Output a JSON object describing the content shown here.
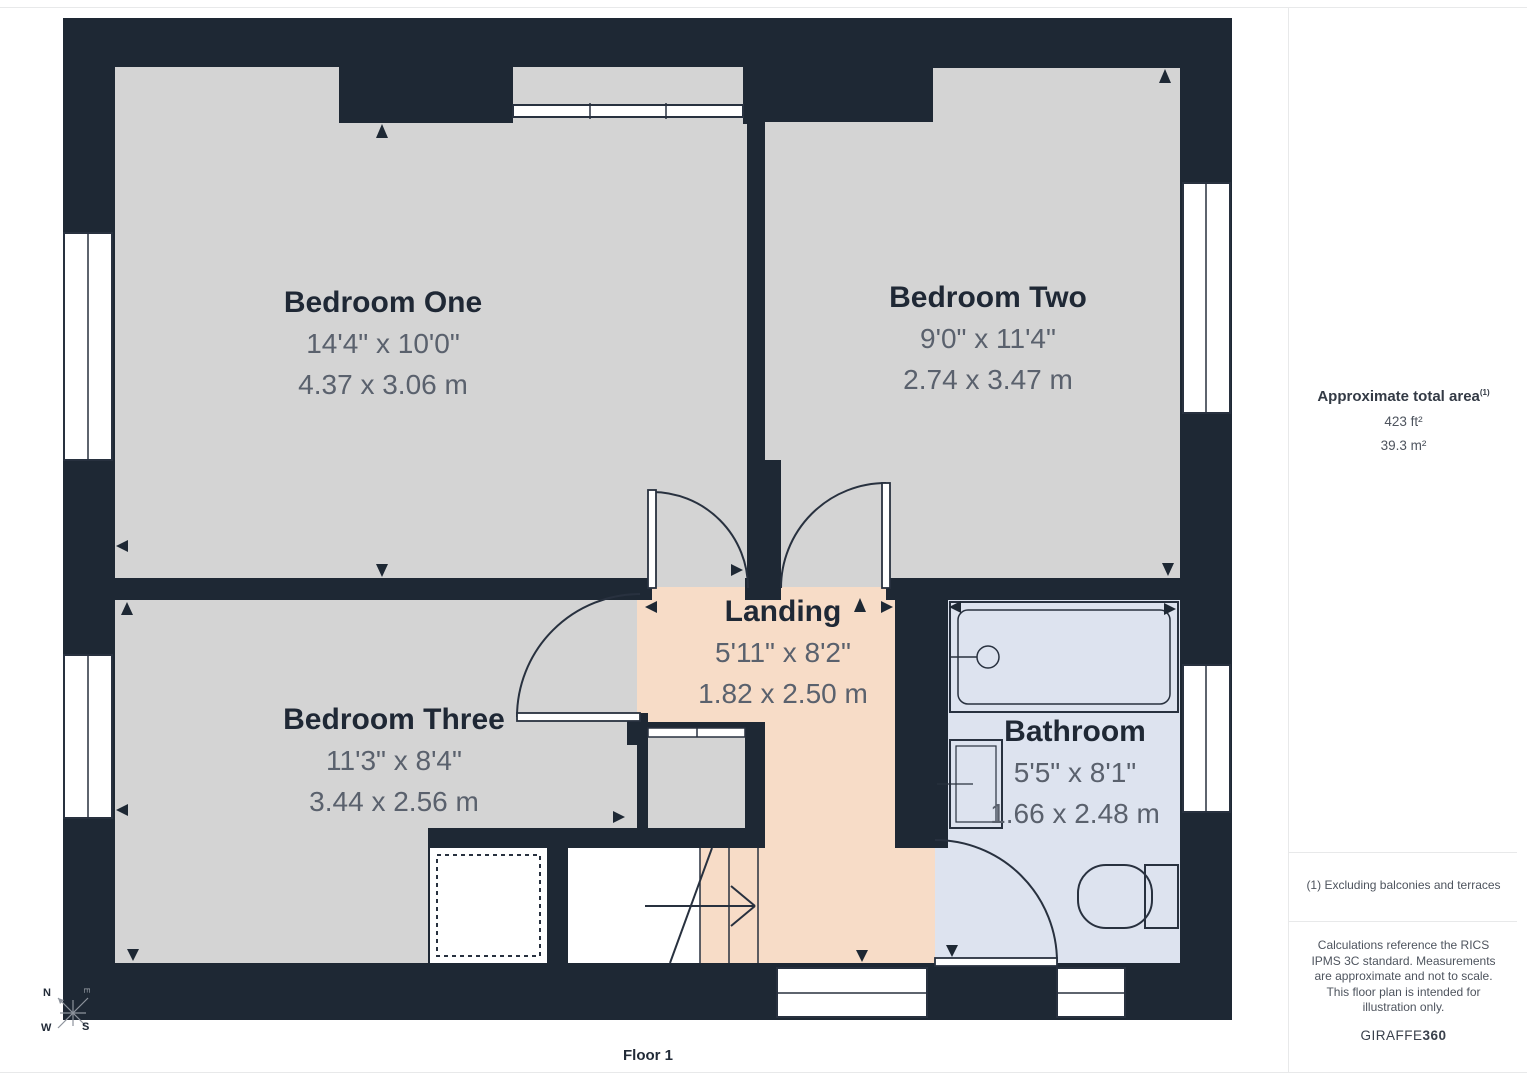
{
  "plan": {
    "floor_label": "Floor 1",
    "rooms": [
      {
        "name": "Bedroom One",
        "imperial": "14'4\" x 10'0\"",
        "metric": "4.37 x 3.06 m"
      },
      {
        "name": "Bedroom Two",
        "imperial": "9'0\" x 11'4\"",
        "metric": "2.74 x 3.47 m"
      },
      {
        "name": "Bedroom Three",
        "imperial": "11'3\" x 8'4\"",
        "metric": "3.44 x 2.56 m"
      },
      {
        "name": "Landing",
        "imperial": "5'11\" x 8'2\"",
        "metric": "1.82 x 2.50 m"
      },
      {
        "name": "Bathroom",
        "imperial": "5'5\" x 8'1\"",
        "metric": "1.66 x 2.48 m"
      }
    ],
    "compass": {
      "north": "N",
      "east": "E",
      "south": "S",
      "west": "W"
    }
  },
  "sidebar": {
    "area_title": "Approximate total area",
    "area_title_sup": "(1)",
    "area_ft": "423 ft²",
    "area_m": "39.3 m²",
    "note1": "(1) Excluding balconies and terraces",
    "disclaimer": "Calculations reference the RICS IPMS 3C standard. Measurements are approximate and not to scale. This floor plan is intended for illustration only.",
    "brand_name": "GIRAFFE",
    "brand_number": "360"
  },
  "colors": {
    "wall": "#1e2834",
    "room_gray": "#d4d4d4",
    "landing_peach": "#f7dcc7",
    "bathroom_blue": "#dde3ef",
    "stroke": "#28313f"
  }
}
